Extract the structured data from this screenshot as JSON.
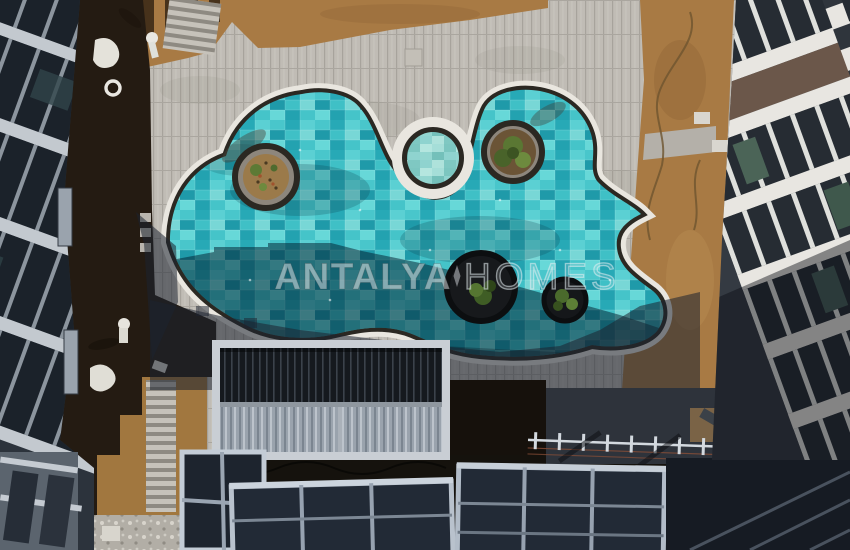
{
  "watermark": {
    "primary": "ANTALYA",
    "secondary": "HOMES"
  },
  "colors": {
    "water": "#2fb4bd",
    "water_pale": "#8fd3cf",
    "water_shadow": "rgba(4,34,50,0.52)",
    "deck": "#e9e6df",
    "coping": "#2b2822",
    "paver": "#c0bcb5",
    "shadow": "rgba(28,34,48,0.55)",
    "dirt": "#a87a44",
    "dirt_lower": "#a1773f",
    "soil_dark": "#241b12",
    "building_light": "#e8e6e1",
    "window_dark": "#262c33",
    "panel_brown": "#6b574a",
    "canopy_glass": "#222a36",
    "canopy_frame": "#b7c0cb",
    "planter_ring": "#8d867c",
    "planter_soil": "#9b7a4a",
    "plant_green": "#5a7733"
  }
}
